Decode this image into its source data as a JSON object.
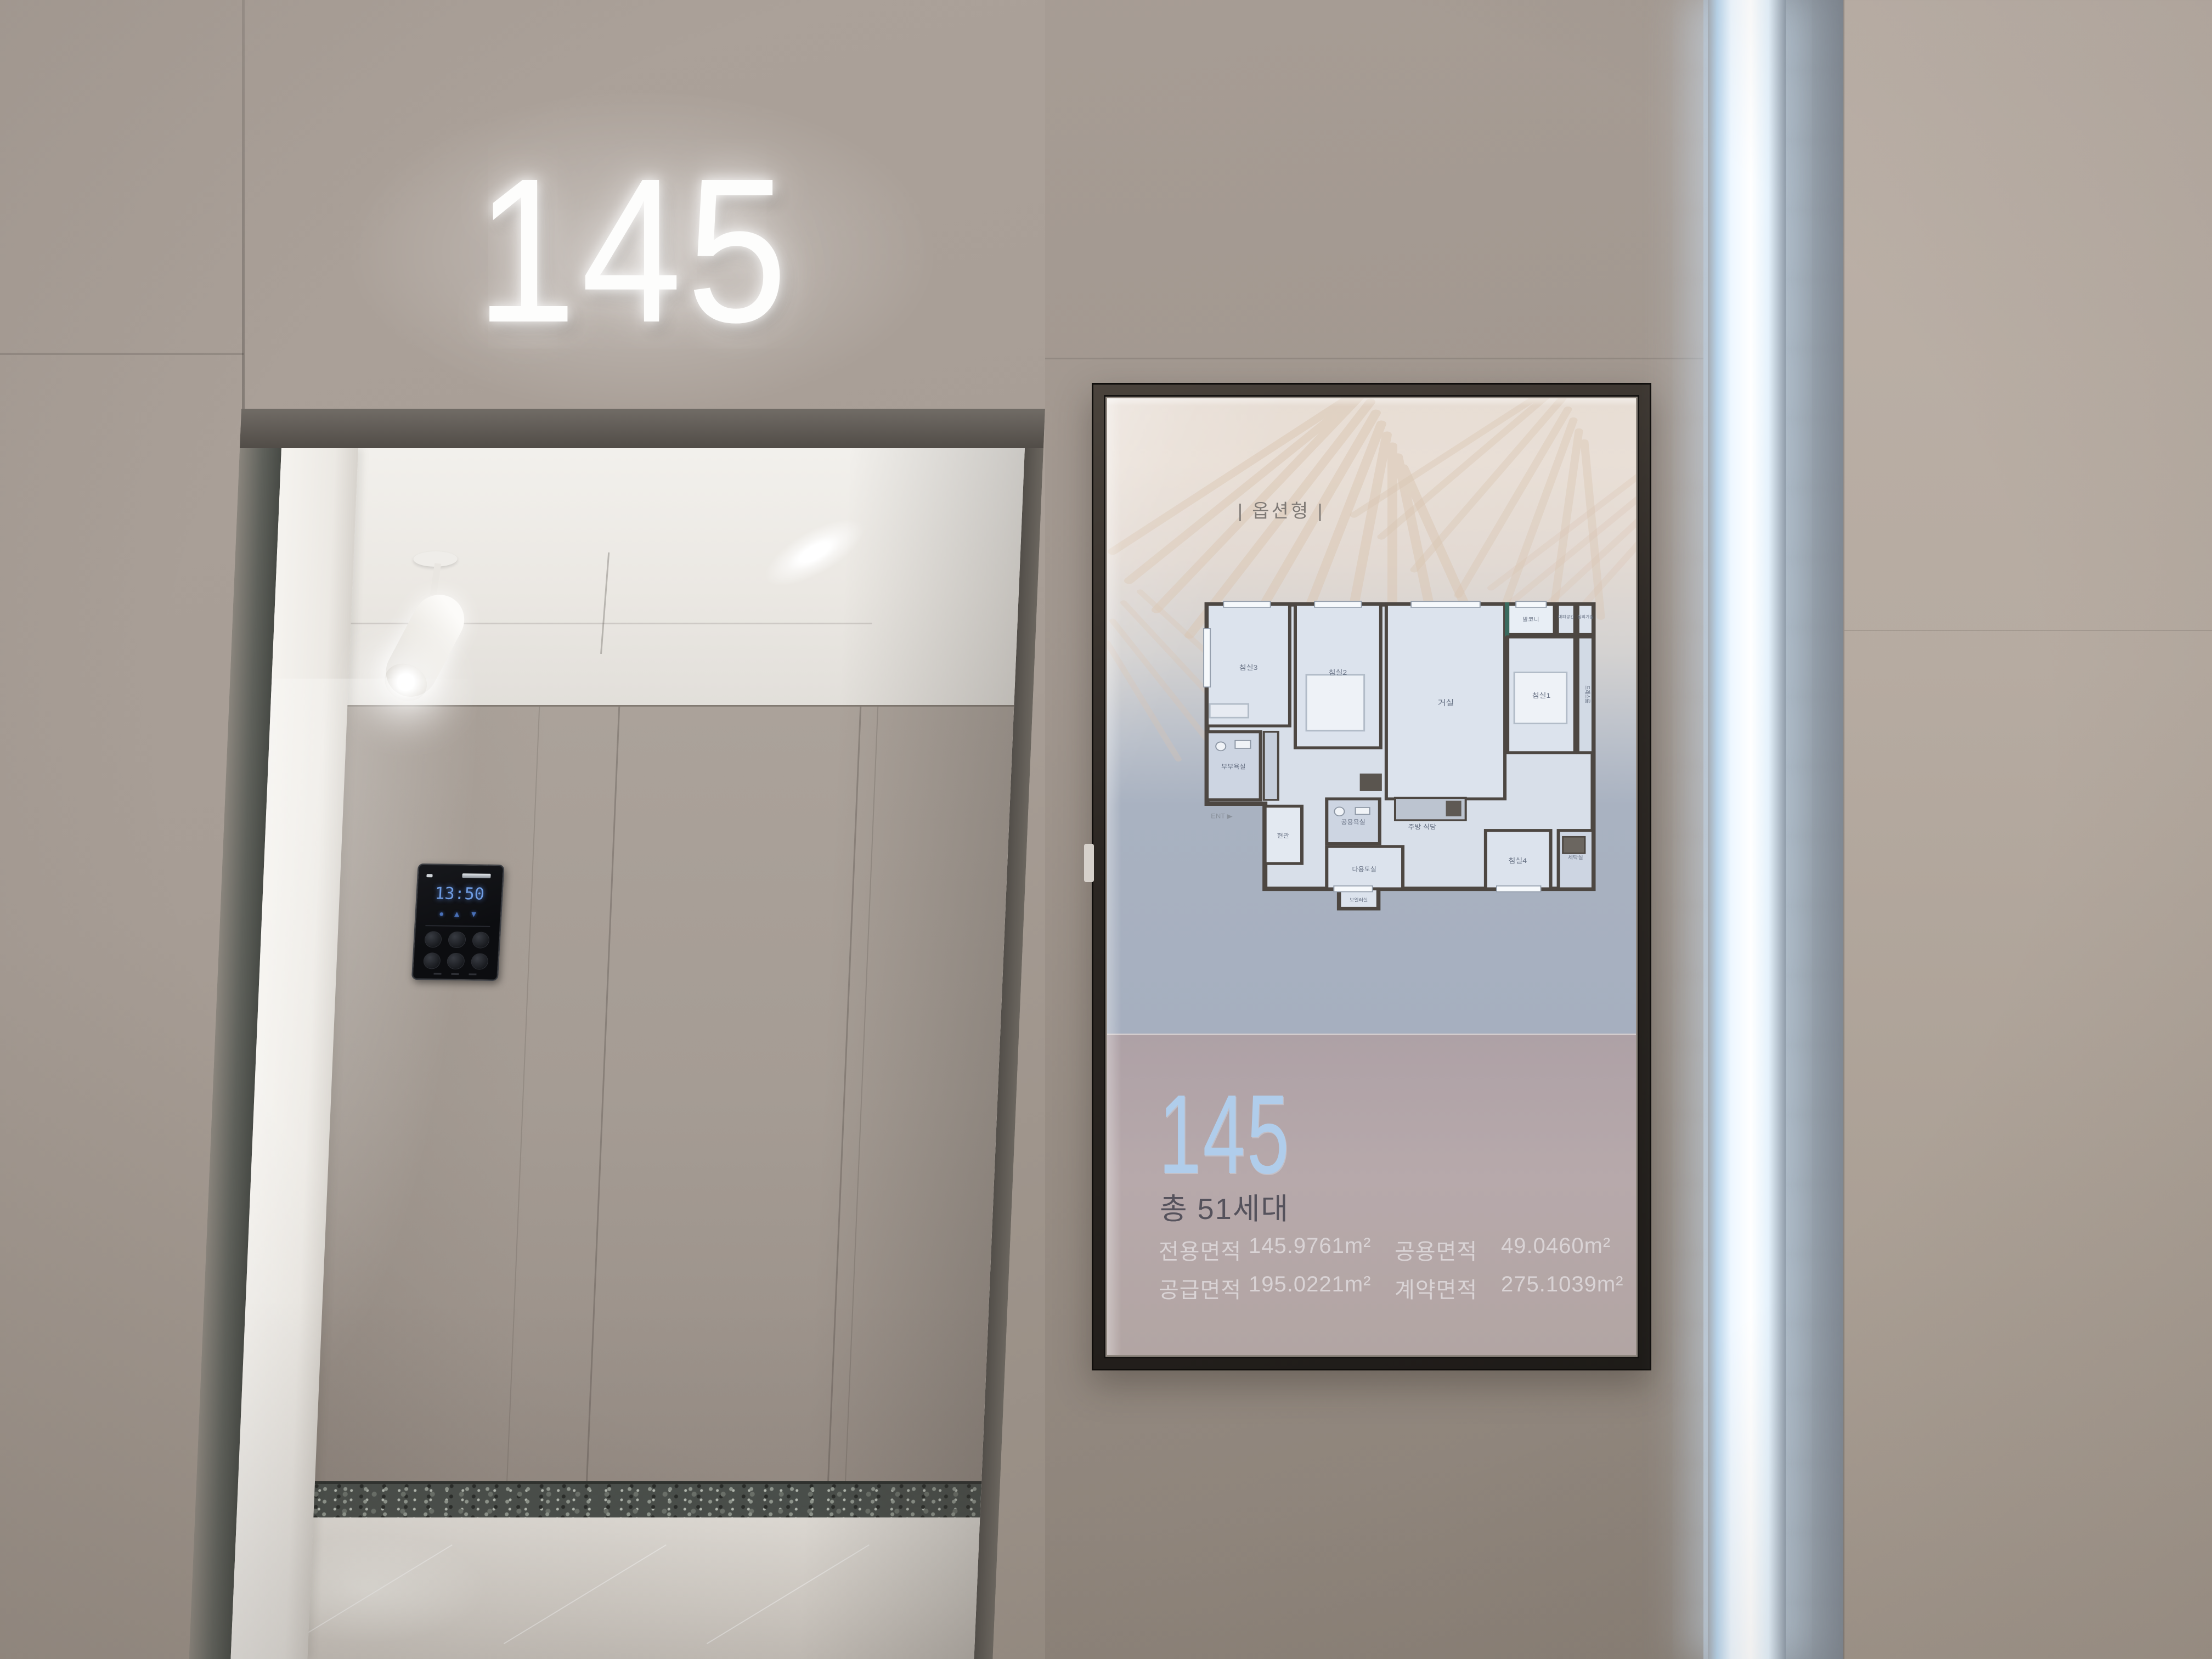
{
  "photo": {
    "wall_sign": {
      "number": "145"
    },
    "elevator_panel": {
      "display_time": "13:50",
      "icons": [
        {
          "name": "status-dot",
          "glyph": "●"
        },
        {
          "name": "up-arrow",
          "glyph": "▲"
        },
        {
          "name": "down-arrow",
          "glyph": "▼"
        }
      ]
    },
    "signage": {
      "header": "| 옵션형 |",
      "unit": {
        "number": "145",
        "households": "총 51세대"
      },
      "areas": [
        {
          "label": "전용면적",
          "value": "145.9761m²"
        },
        {
          "label": "공용면적",
          "value": "49.0460m²"
        },
        {
          "label": "공급면적",
          "value": "195.0221m²"
        },
        {
          "label": "계약면적",
          "value": "275.1039m²"
        }
      ],
      "floorplan": {
        "ent": "ENT ▶",
        "rooms": [
          {
            "id": "bedroom3",
            "label": "침실3"
          },
          {
            "id": "bedroom2",
            "label": "침실2"
          },
          {
            "id": "living",
            "label": "거실"
          },
          {
            "id": "balcony",
            "label": "발코니"
          },
          {
            "id": "refuge",
            "label": "대피공간"
          },
          {
            "id": "outdoor-unit",
            "label": "실외기실"
          },
          {
            "id": "bedroom1",
            "label": "침실1"
          },
          {
            "id": "dressroom",
            "label": "드레스룸"
          },
          {
            "id": "master-bath",
            "label": "부부욕실"
          },
          {
            "id": "entry",
            "label": "현관"
          },
          {
            "id": "common-bath",
            "label": "공용욕실"
          },
          {
            "id": "kitchen-dining",
            "label": "주방 식당"
          },
          {
            "id": "utility",
            "label": "다용도실"
          },
          {
            "id": "bedroom4",
            "label": "침실4"
          },
          {
            "id": "laundry",
            "label": "세탁실"
          },
          {
            "id": "boiler",
            "label": "보일러실"
          }
        ]
      }
    },
    "colors": {
      "wall_taupe": "#a79d95",
      "screen_cream": "#e8ded5",
      "info_band_mauve": "#b3a6a9",
      "unit_number_blue": "#b0cdeb",
      "led_glow": "#eef7ff",
      "floorplan_wall": "#4d4742",
      "floorplan_room": "#dce3ed"
    }
  }
}
